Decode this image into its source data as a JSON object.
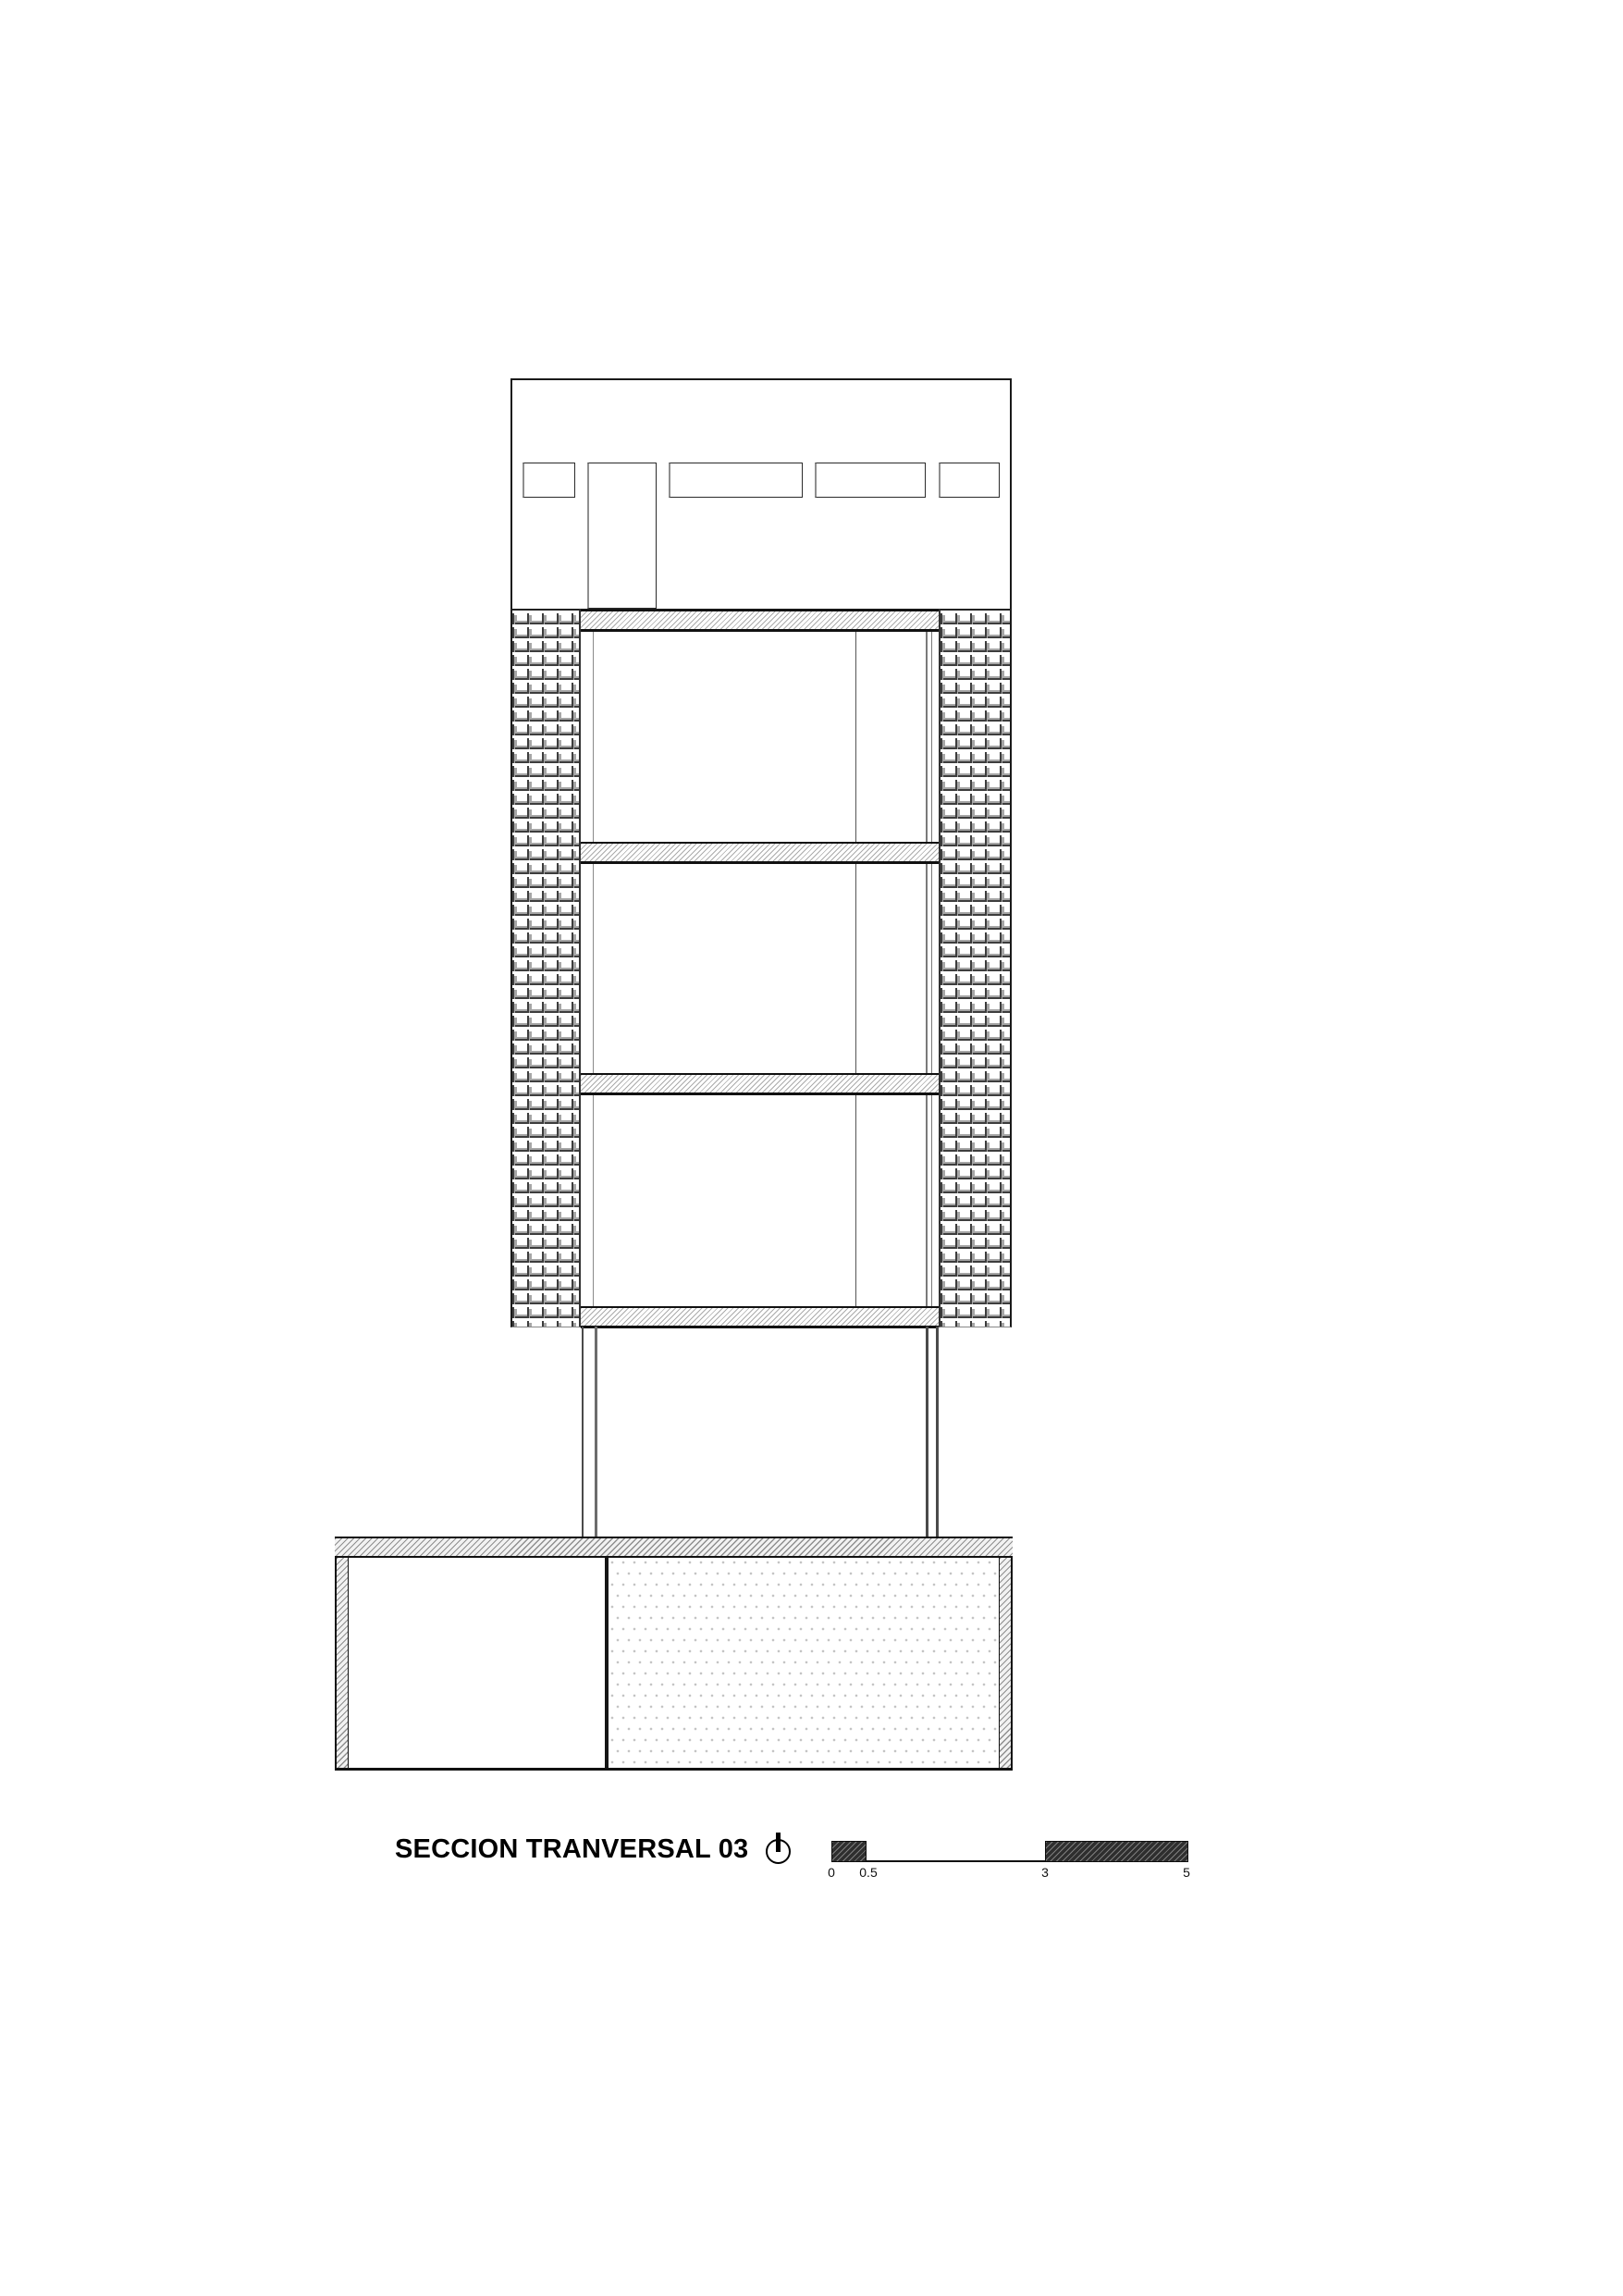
{
  "drawing": {
    "title": "SECCION TRANVERSAL 03"
  },
  "north_indicator": {
    "icon": "north-arrow-icon"
  },
  "scale_bar": {
    "labels": [
      "0",
      "0.5",
      "3",
      "5"
    ]
  },
  "colors": {
    "line": "#1a1a1a",
    "slab_hatch": "#ababab",
    "scale_block": "#2e2e2e",
    "dot_fill": "#c2c2c2"
  }
}
